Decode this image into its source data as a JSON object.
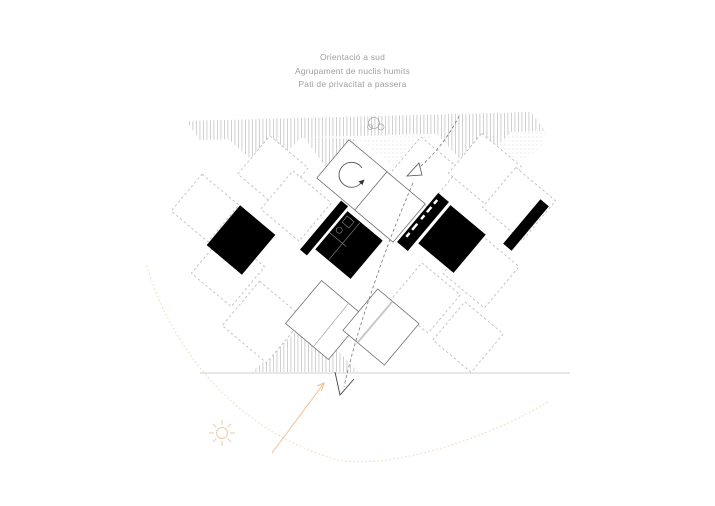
{
  "captions": {
    "line1": "Orientació a sud",
    "line2": "Agrupament de nuclis humits",
    "line3": "Pati de privacitat a passera"
  },
  "diagram": {
    "type": "architectural-concept-plan",
    "module_grid": {
      "rotation_deg": 40,
      "solid_outline_tiles": 4,
      "dashed_outline_tiles": 11,
      "black_core_blocks": 6
    },
    "annotations": [
      "hatched south band with tree",
      "rotation arrow inside module",
      "dashed circulation path through patio with arrowheads",
      "ground line",
      "sun with south-facing arrow and dotted sun-path arc"
    ]
  },
  "colors": {
    "caption_text": "#9e9e9e",
    "hatch_line": "#c4c4c4",
    "dot_texture": "#dedede",
    "tile_dashed_stroke": "#b8b8b8",
    "tile_solid_stroke": "#707070",
    "core_fill": "#000000",
    "path_stroke": "#777777",
    "ground_line": "#d9d9d9",
    "sun_accent": "#eec9a2",
    "south_arrow_accent": "#f2bd8f",
    "sun_arc_accent": "#f0d6bd"
  },
  "icons": {
    "sun": "sun-icon",
    "tree": "tree-icon",
    "rotation_arrow": "rotation-arrow-icon",
    "flow_arrowhead": "flow-arrowhead-icon",
    "south_arrow": "south-arrow-icon"
  }
}
